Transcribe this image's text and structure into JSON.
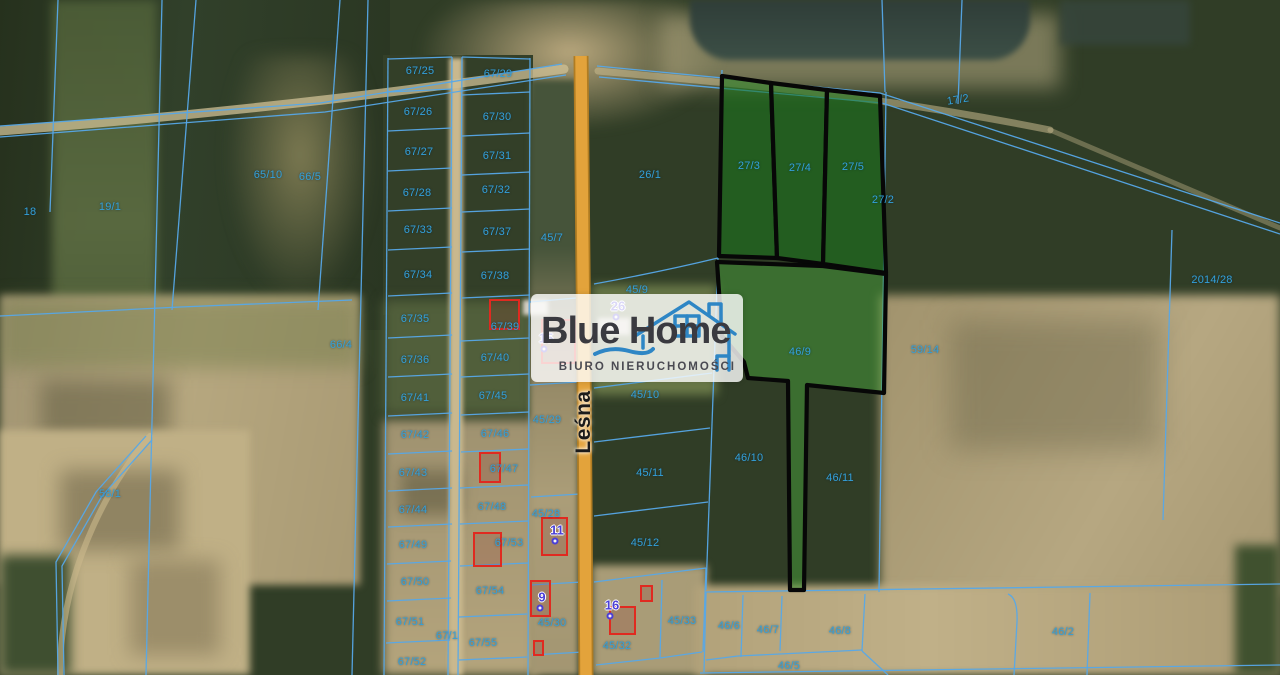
{
  "branding": {
    "title": "Blue Home",
    "subtitle": "BIURO NIERUCHOMOŚCI"
  },
  "road": {
    "name": "Leśna"
  },
  "highlighted_parcels": {
    "ids": [
      "27/3",
      "27/4",
      "27/5",
      "46/9"
    ],
    "fill_top": "#1e761c",
    "fill_big": "#46a03a",
    "outline": "#070707"
  },
  "colors": {
    "cadastral_line": "#56a8e8",
    "parcel_label": "#33a0da",
    "road_fill": "#e3a33b",
    "road_edge": "#b07c22",
    "house_outline": "#e02a20",
    "marker_number": "#4b3fd6",
    "logo_blue": "#2e86c5"
  },
  "parcel_labels": [
    {
      "t": "18",
      "x": 30,
      "y": 212
    },
    {
      "t": "19/1",
      "x": 110,
      "y": 207
    },
    {
      "t": "65/10",
      "x": 268,
      "y": 175
    },
    {
      "t": "66/5",
      "x": 310,
      "y": 177
    },
    {
      "t": "66/4",
      "x": 341,
      "y": 345
    },
    {
      "t": "58/1",
      "x": 110,
      "y": 494
    },
    {
      "t": "67/25",
      "x": 420,
      "y": 71
    },
    {
      "t": "67/26",
      "x": 418,
      "y": 112
    },
    {
      "t": "67/27",
      "x": 419,
      "y": 152
    },
    {
      "t": "67/28",
      "x": 417,
      "y": 193
    },
    {
      "t": "67/33",
      "x": 418,
      "y": 230
    },
    {
      "t": "67/34",
      "x": 418,
      "y": 275
    },
    {
      "t": "67/35",
      "x": 415,
      "y": 319
    },
    {
      "t": "67/36",
      "x": 415,
      "y": 360
    },
    {
      "t": "67/41",
      "x": 415,
      "y": 398
    },
    {
      "t": "67/42",
      "x": 415,
      "y": 435
    },
    {
      "t": "67/43",
      "x": 413,
      "y": 473
    },
    {
      "t": "67/44",
      "x": 413,
      "y": 510
    },
    {
      "t": "67/49",
      "x": 413,
      "y": 545
    },
    {
      "t": "67/50",
      "x": 415,
      "y": 582
    },
    {
      "t": "67/51",
      "x": 410,
      "y": 622
    },
    {
      "t": "67/52",
      "x": 412,
      "y": 662
    },
    {
      "t": "67/29",
      "x": 498,
      "y": 74
    },
    {
      "t": "67/30",
      "x": 497,
      "y": 117
    },
    {
      "t": "67/31",
      "x": 497,
      "y": 156
    },
    {
      "t": "67/32",
      "x": 496,
      "y": 190
    },
    {
      "t": "67/37",
      "x": 497,
      "y": 232
    },
    {
      "t": "67/38",
      "x": 495,
      "y": 276
    },
    {
      "t": "67/39",
      "x": 505,
      "y": 327
    },
    {
      "t": "67/40",
      "x": 495,
      "y": 358
    },
    {
      "t": "67/45",
      "x": 493,
      "y": 396
    },
    {
      "t": "67/46",
      "x": 495,
      "y": 434
    },
    {
      "t": "67/47",
      "x": 504,
      "y": 469
    },
    {
      "t": "67/48",
      "x": 492,
      "y": 507
    },
    {
      "t": "67/53",
      "x": 509,
      "y": 543
    },
    {
      "t": "67/54",
      "x": 490,
      "y": 591
    },
    {
      "t": "67/55",
      "x": 483,
      "y": 643
    },
    {
      "t": "67/1",
      "x": 447,
      "y": 636
    },
    {
      "t": "45/7",
      "x": 552,
      "y": 238
    },
    {
      "t": "45/29",
      "x": 547,
      "y": 420
    },
    {
      "t": "45/28",
      "x": 546,
      "y": 514
    },
    {
      "t": "45/30",
      "x": 552,
      "y": 623
    },
    {
      "t": "26/1",
      "x": 650,
      "y": 175
    },
    {
      "t": "45/9",
      "x": 637,
      "y": 290
    },
    {
      "t": "45/10",
      "x": 645,
      "y": 395
    },
    {
      "t": "45/11",
      "x": 650,
      "y": 473
    },
    {
      "t": "45/12",
      "x": 645,
      "y": 543
    },
    {
      "t": "45/33",
      "x": 682,
      "y": 621
    },
    {
      "t": "45/32",
      "x": 617,
      "y": 646
    },
    {
      "t": "27/3",
      "x": 749,
      "y": 166
    },
    {
      "t": "27/4",
      "x": 800,
      "y": 168
    },
    {
      "t": "27/5",
      "x": 853,
      "y": 167
    },
    {
      "t": "27/2",
      "x": 883,
      "y": 200
    },
    {
      "t": "46/9",
      "x": 800,
      "y": 352
    },
    {
      "t": "59/14",
      "x": 925,
      "y": 350
    },
    {
      "t": "2014/28",
      "x": 1212,
      "y": 280
    },
    {
      "t": "17/2",
      "x": 958,
      "y": 100,
      "r": -9
    },
    {
      "t": "46/10",
      "x": 749,
      "y": 458
    },
    {
      "t": "46/11",
      "x": 840,
      "y": 478
    },
    {
      "t": "46/6",
      "x": 729,
      "y": 626
    },
    {
      "t": "46/7",
      "x": 768,
      "y": 630
    },
    {
      "t": "46/8",
      "x": 840,
      "y": 631
    },
    {
      "t": "46/5",
      "x": 789,
      "y": 666
    },
    {
      "t": "46/2",
      "x": 1063,
      "y": 632
    }
  ],
  "house_markers": [
    {
      "t": "26",
      "x": 618,
      "y": 306
    },
    {
      "t": "15",
      "x": 546,
      "y": 338
    },
    {
      "t": "11",
      "x": 557,
      "y": 530
    },
    {
      "t": "9",
      "x": 542,
      "y": 597
    },
    {
      "t": "16",
      "x": 612,
      "y": 605
    }
  ],
  "house_outlines": [
    {
      "x": 489,
      "y": 299,
      "w": 31,
      "h": 31
    },
    {
      "x": 541,
      "y": 319,
      "w": 35,
      "h": 45
    },
    {
      "x": 479,
      "y": 452,
      "w": 22,
      "h": 31
    },
    {
      "x": 473,
      "y": 532,
      "w": 29,
      "h": 35
    },
    {
      "x": 541,
      "y": 517,
      "w": 27,
      "h": 39
    },
    {
      "x": 530,
      "y": 580,
      "w": 21,
      "h": 37
    },
    {
      "x": 533,
      "y": 640,
      "w": 11,
      "h": 16
    },
    {
      "x": 609,
      "y": 606,
      "w": 27,
      "h": 29
    },
    {
      "x": 640,
      "y": 585,
      "w": 13,
      "h": 17
    }
  ]
}
